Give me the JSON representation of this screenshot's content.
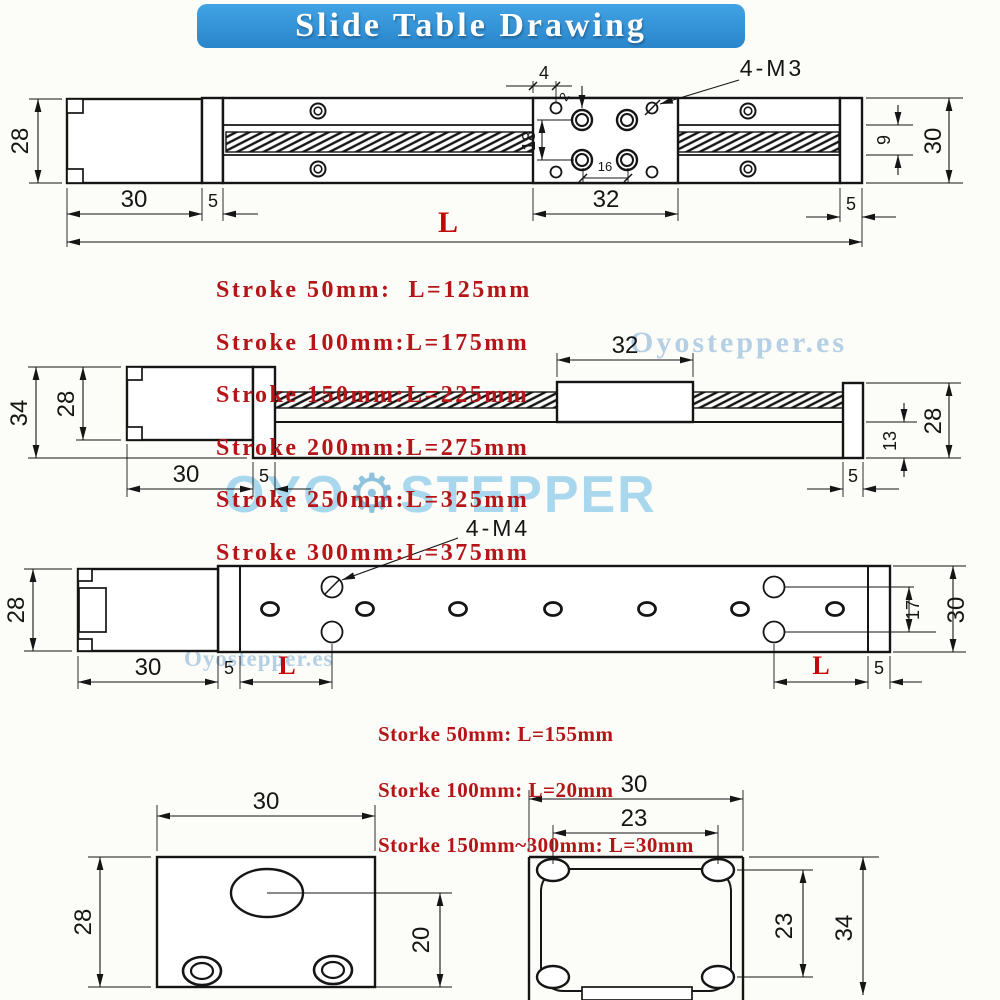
{
  "title": {
    "text": "Slide Table Drawing"
  },
  "watermarks": {
    "small_top": "Oyostepper.es",
    "small_bottom": "Oyostepper.es",
    "big_left": "OYO",
    "big_right": "STEPPER",
    "gear_glyph": "⚙"
  },
  "colors": {
    "banner_blue": "#2e8fd5",
    "dimension_red": "#c40808",
    "table_red": "#b51518",
    "watermark_blue": "#b5d0e4",
    "line_black": "#151515"
  },
  "top_view": {
    "thread_label": "4-M3",
    "dim_hole_offset": "4",
    "dim_tiny": "2",
    "dim_hole_span_v": "18",
    "dim_hole_span_h": "16",
    "dim_motor_height": "28",
    "dim_motor_length": "30",
    "dim_flange_left": "5",
    "dim_carriage_length": "32",
    "dim_flange_right": "5",
    "dim_length_label": "L",
    "dim_slot_height": "9",
    "dim_overall_height": "30"
  },
  "stroke_table_top": {
    "lines": [
      "Stroke 50mm:  L=125mm",
      "Stroke 100mm:L=175mm",
      "Stroke 150mm:L=225mm",
      "Stroke 200mm:L=275mm",
      "Stroke 250mm:L=325mm",
      "Stroke 300mm:L=375mm"
    ]
  },
  "side_view": {
    "dim_overall_height": "34",
    "dim_motor_height": "28",
    "dim_motor_length": "30",
    "dim_flange_left": "5",
    "dim_carriage_length": "32",
    "dim_base_height": "13",
    "dim_end_height": "28",
    "dim_flange_right": "5"
  },
  "bottom_view": {
    "thread_label": "4-M4",
    "dim_motor_height": "28",
    "dim_motor_length": "30",
    "dim_flange_left": "5",
    "dim_L_left": "L",
    "dim_L_right": "L",
    "dim_flange_right": "5",
    "dim_hole_span": "17",
    "dim_overall_height": "30"
  },
  "stroke_table_bottom": {
    "lines": [
      "Storke 50mm: L=155mm",
      "Storke 100mm: L=20mm",
      "Storke 150mm~300mm: L=30mm"
    ]
  },
  "detail_left": {
    "dim_width": "30",
    "dim_height": "28",
    "dim_hole_offset": "20"
  },
  "detail_right": {
    "dim_width": "30",
    "dim_hole_span_h": "23",
    "dim_hole_span_v": "23",
    "dim_height": "34"
  }
}
